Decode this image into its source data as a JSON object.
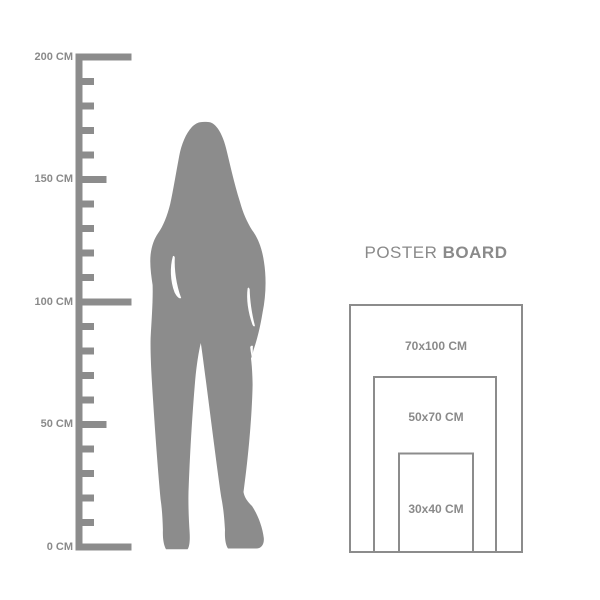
{
  "background_color": "#ffffff",
  "accent_gray": "#8c8c8c",
  "text_gray": "#8a8a8a",
  "ruler": {
    "unit": "CM",
    "min_cm": 0,
    "max_cm": 200,
    "tick_step_cm": 10,
    "labeled_ticks": [
      {
        "text": "200 CM",
        "cm": 200
      },
      {
        "text": "150 CM",
        "cm": 150
      },
      {
        "text": "100 CM",
        "cm": 100
      },
      {
        "text": "50 CM",
        "cm": 50
      },
      {
        "text": "0 CM",
        "cm": 0
      }
    ]
  },
  "figure": {
    "icon": "woman-silhouette"
  },
  "poster_board": {
    "title_regular": "POSTER",
    "title_bold": "BOARD",
    "sizes": [
      {
        "label": "70x100 CM",
        "width_cm": 70,
        "height_cm": 100
      },
      {
        "label": "50x70 CM",
        "width_cm": 50,
        "height_cm": 70
      },
      {
        "label": "30x40 CM",
        "width_cm": 30,
        "height_cm": 40
      }
    ]
  }
}
